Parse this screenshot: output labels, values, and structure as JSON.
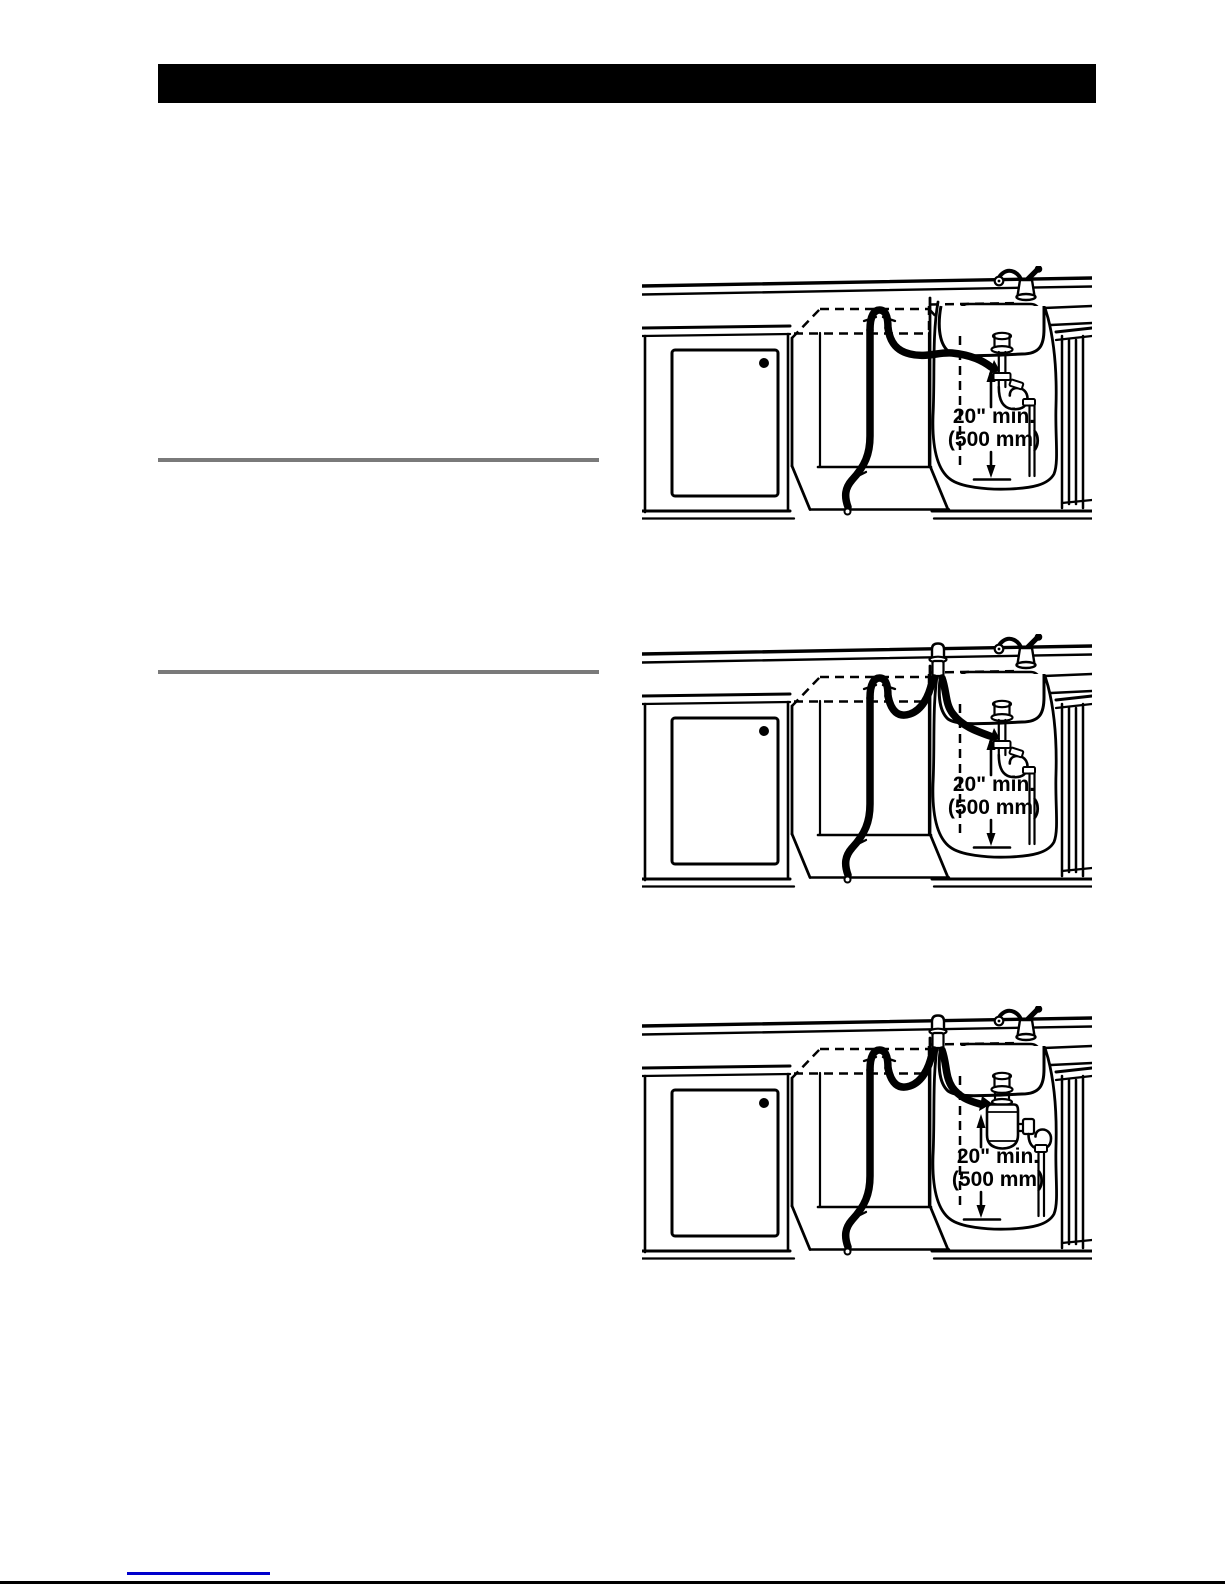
{
  "page": {
    "width_px": 1225,
    "height_px": 1585,
    "background": "#ffffff"
  },
  "header": {
    "bar_color": "#000000"
  },
  "dividers": {
    "color": "#7a7a7a"
  },
  "figures": [
    {
      "variant": "direct",
      "icon": "drain-hose-high-loop-direct-to-sink-drain-illustration",
      "label_line1": "20\" min.",
      "label_line2": "(500 mm)"
    },
    {
      "variant": "air-gap-sink",
      "icon": "drain-hose-air-gap-to-sink-drain-illustration",
      "label_line1": "20\" min.",
      "label_line2": "(500 mm)"
    },
    {
      "variant": "air-gap-disposer",
      "icon": "drain-hose-air-gap-to-disposer-illustration",
      "label_line1": "20\" min.",
      "label_line2": "(500 mm)"
    }
  ],
  "footer": {
    "link_underline_color": "#0000cc",
    "bottom_rule_color": "#000000"
  }
}
